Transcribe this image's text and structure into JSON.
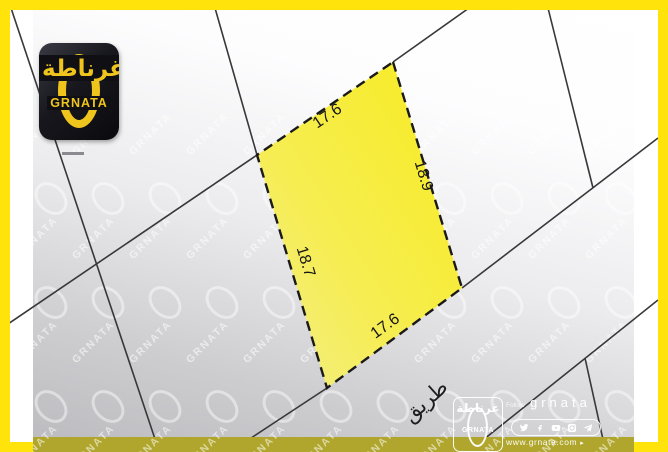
{
  "brand": {
    "logo_arabic": "غرناطة",
    "logo_latin": "GRNATA"
  },
  "plot_dimensions": {
    "top": "17.6",
    "right": "18.9",
    "bottom": "17.6",
    "left": "18.7"
  },
  "map_labels": {
    "road": "طريق"
  },
  "watermark": {
    "text": "GRNATA"
  },
  "footer": {
    "follow_label": "Follow",
    "handle": "grnata",
    "website": "www.grnata.com",
    "social_icons": [
      "twitter",
      "facebook",
      "youtube",
      "instagram",
      "telegram"
    ]
  },
  "colors": {
    "frame_yellow": "#FFE30A",
    "plot_yellow": "#F7EB27",
    "strip_olive": "#B0A62D",
    "logo_yellow": "#EFC51D",
    "parcel_line": "#38383A"
  }
}
